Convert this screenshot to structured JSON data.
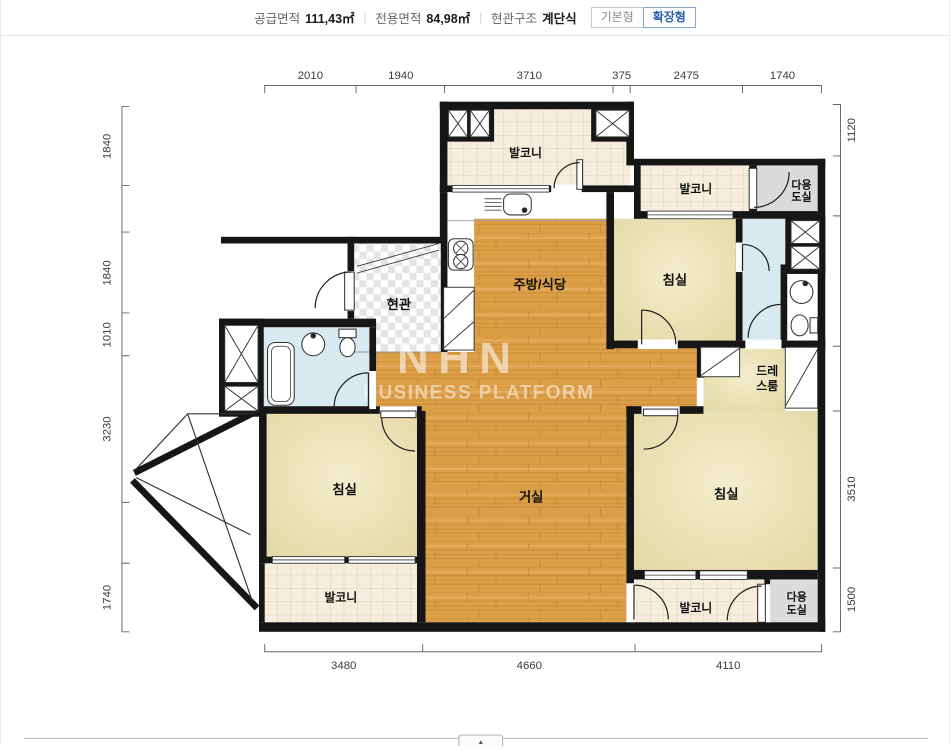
{
  "header": {
    "fields": [
      {
        "label": "공급면적",
        "value": "111,43㎡"
      },
      {
        "label": "전용면적",
        "value": "84,98㎡"
      },
      {
        "label": "현관구조",
        "value": "계단식"
      }
    ],
    "separator": "|",
    "toggle": {
      "basic": "기본형",
      "extended": "확장형"
    }
  },
  "plan": {
    "rooms": {
      "balcony_top": "발코니",
      "balcony_top_right": "발코니",
      "utility_top_line1": "다용",
      "utility_top_line2": "도실",
      "bedroom_top_right": "침실",
      "kitchen": "주방/식당",
      "entrance": "현관",
      "dress_line1": "드레",
      "dress_line2": "스룸",
      "living": "거실",
      "bedroom_left": "침실",
      "bedroom_right": "침실",
      "balcony_bottom_left": "발코니",
      "balcony_bottom_right": "발코니",
      "utility_bottom_line1": "다용",
      "utility_bottom_line2": "도실"
    },
    "dims": {
      "top": [
        "2010",
        "1940",
        "3710",
        "375",
        "2475",
        "1740"
      ],
      "bottom": [
        "3480",
        "4660",
        "4110"
      ],
      "left": [
        "1840",
        "1840",
        "1010",
        "3230",
        "1740"
      ],
      "right": [
        "1120",
        "3510",
        "1500"
      ]
    },
    "watermark": {
      "line1": "NHN",
      "line2": "BUSINESS PLATFORM"
    }
  },
  "footer": {
    "arrow": "▲"
  },
  "colors": {
    "wall": "#161616",
    "wood": "#DC9F48",
    "tile": "#F6EEDC",
    "bedroom": "#E7DCAE",
    "bath": "#D8E9F0",
    "utility_gray": "#DBDBDB",
    "accent_blue": "#2B5FAE"
  }
}
